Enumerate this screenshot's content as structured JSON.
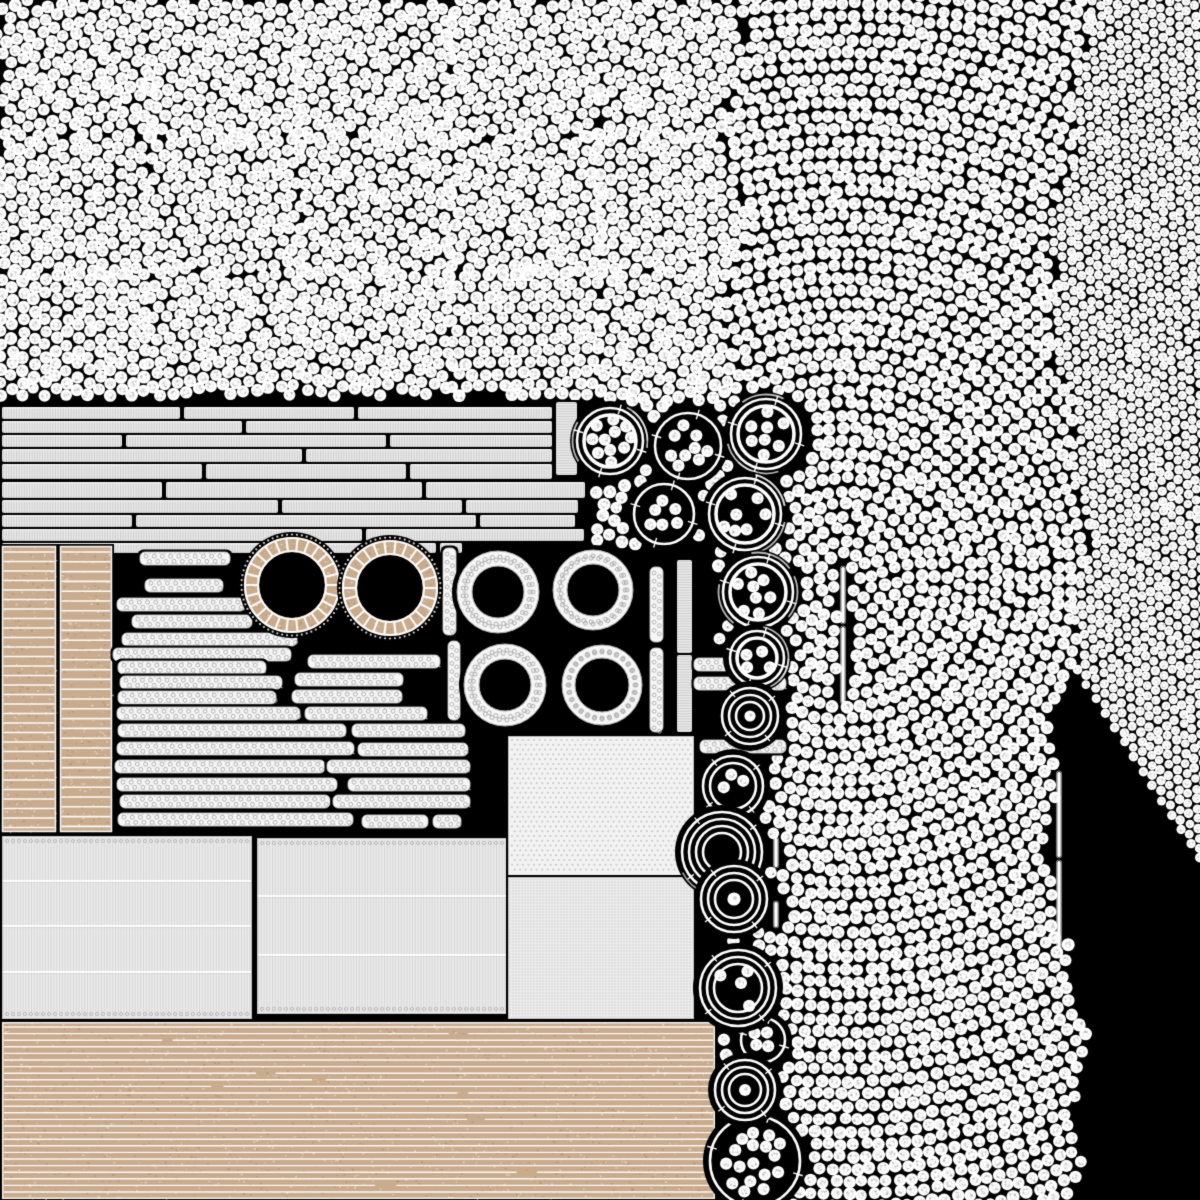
{
  "scene": {
    "width": 1200,
    "height": 1200,
    "background": "#000000",
    "seed": 11
  },
  "palette": {
    "dot": "#ffffff",
    "dot_speckle": "rgba(150,150,150,0.45)",
    "dot_ring": "rgba(170,170,170,0.35)",
    "plank": "#e9e9e9",
    "strip": "#f6f6f6",
    "sheet": "#ebebeb",
    "square": "#f3f3f3",
    "tan": "#c9ab8e",
    "tan_dark": "rgba(150,110,70,0.35)",
    "tan_light": "rgba(255,246,230,0.5)",
    "white": "#ffffff",
    "gray_line": "#b5b5b5"
  },
  "dot_field": {
    "center": [
      845,
      580
    ],
    "spacing": 12.7,
    "dot_radius": 6.2,
    "fine_spacing": 9.9,
    "fine_dot_radius": 4.6,
    "fine_boundary_x": 1068,
    "fine_angle_deg": -33,
    "linear_max_y": 404,
    "linear_max_x": 735,
    "linear_cell": [
      150,
      136
    ],
    "max_radius": 1080,
    "exclusion_rects": [
      [
        0,
        396,
        592,
        152
      ],
      [
        0,
        545,
        716,
        655
      ]
    ]
  },
  "sticks": [
    [
      843,
      567,
      3.5,
      56
    ],
    [
      843,
      627,
      3.5,
      76
    ],
    [
      1059,
      772,
      3.5,
      85
    ],
    [
      1059,
      861,
      3.5,
      87
    ],
    [
      776,
      838,
      3.5,
      29
    ],
    [
      776,
      902,
      3.5,
      25
    ]
  ],
  "planks": {
    "rows": [
      {
        "y": 407,
        "h": 12,
        "segs": [
          [
            2,
            178
          ],
          [
            184,
            170
          ],
          [
            358,
            194
          ]
        ]
      },
      {
        "y": 421,
        "h": 12,
        "segs": [
          [
            2,
            240
          ],
          [
            246,
            306
          ]
        ]
      },
      {
        "y": 435,
        "h": 12,
        "segs": [
          [
            2,
            120
          ],
          [
            126,
            260
          ],
          [
            390,
            162
          ]
        ]
      },
      {
        "y": 449,
        "h": 13,
        "segs": [
          [
            2,
            300
          ],
          [
            306,
            246
          ]
        ]
      },
      {
        "y": 464,
        "h": 15,
        "segs": [
          [
            2,
            200
          ],
          [
            206,
            200
          ],
          [
            410,
            142
          ]
        ]
      },
      {
        "y": 482,
        "h": 16,
        "segs": [
          [
            2,
            160
          ],
          [
            166,
            256
          ],
          [
            426,
            159
          ]
        ]
      },
      {
        "y": 500,
        "h": 13,
        "segs": [
          [
            2,
            276
          ],
          [
            282,
            180
          ],
          [
            466,
            112
          ]
        ]
      },
      {
        "y": 515,
        "h": 12,
        "segs": [
          [
            2,
            130
          ],
          [
            136,
            340
          ],
          [
            480,
            95
          ]
        ]
      },
      {
        "y": 529,
        "h": 12,
        "segs": [
          [
            2,
            360
          ],
          [
            366,
            218
          ]
        ]
      },
      {
        "y": 543,
        "h": 10,
        "segs": [
          [
            2,
            434
          ],
          [
            440,
            22
          ]
        ]
      }
    ]
  },
  "vplanks": [
    [
      556,
      402,
      21,
      73
    ],
    [
      677,
      560,
      15,
      93
    ],
    [
      677,
      655,
      15,
      77
    ]
  ],
  "strips": {
    "height": 13,
    "items": [
      [
        140,
        552,
        90
      ],
      [
        145,
        579,
        78
      ],
      [
        117,
        598,
        128
      ],
      [
        132,
        615,
        120
      ],
      [
        122,
        633,
        175
      ],
      [
        113,
        648,
        178
      ],
      [
        118,
        661,
        148
      ],
      [
        120,
        676,
        162
      ],
      [
        118,
        691,
        158
      ],
      [
        117,
        707,
        183
      ],
      [
        118,
        724,
        228
      ],
      [
        117,
        742,
        237
      ],
      [
        115,
        760,
        210
      ],
      [
        117,
        778,
        220
      ],
      [
        120,
        795,
        210
      ],
      [
        118,
        813,
        235
      ],
      [
        308,
        655,
        132
      ],
      [
        295,
        673,
        108
      ],
      [
        292,
        690,
        110
      ],
      [
        305,
        707,
        122
      ],
      [
        352,
        724,
        113
      ],
      [
        358,
        743,
        110
      ],
      [
        327,
        760,
        143
      ],
      [
        348,
        778,
        122
      ],
      [
        333,
        795,
        137
      ],
      [
        362,
        815,
        66
      ],
      [
        433,
        815,
        28
      ],
      [
        694,
        658,
        92
      ],
      [
        694,
        677,
        92
      ],
      [
        700,
        740,
        86
      ]
    ]
  },
  "vstrips": [
    [
      443,
      548,
      13,
      87
    ],
    [
      448,
      641,
      12,
      79
    ],
    [
      650,
      567,
      13,
      75
    ],
    [
      650,
      648,
      13,
      84
    ]
  ],
  "tan_rings": [
    {
      "cx": 292,
      "cy": 585,
      "ro": 48,
      "ri": 33,
      "spokes": 26
    },
    {
      "cx": 390,
      "cy": 588,
      "ro": 48,
      "ri": 33,
      "spokes": 26
    }
  ],
  "dotted_rings": [
    {
      "cx": 498,
      "cy": 592,
      "ro": 41,
      "ri": 26
    },
    {
      "cx": 593,
      "cy": 590,
      "ro": 40,
      "ri": 26
    },
    {
      "cx": 505,
      "cy": 685,
      "ro": 41,
      "ri": 26
    },
    {
      "cx": 602,
      "cy": 685,
      "ro": 40,
      "ri": 27
    }
  ],
  "bundles": [
    {
      "cx": 610,
      "cy": 441,
      "r": 33,
      "ring": "double",
      "dots": 11
    },
    {
      "cx": 688,
      "cy": 446,
      "r": 33,
      "ring": "single",
      "dots": 12
    },
    {
      "cx": 766,
      "cy": 434,
      "r": 35,
      "ring": "double",
      "dots": 8
    },
    {
      "cx": 664,
      "cy": 514,
      "r": 30,
      "ring": "single",
      "dots": 9
    },
    {
      "cx": 745,
      "cy": 514,
      "r": 36,
      "ring": "double",
      "dots": 7
    },
    {
      "cx": 758,
      "cy": 592,
      "r": 35,
      "ring": "double",
      "dots": 8
    },
    {
      "cx": 757,
      "cy": 658,
      "r": 27,
      "ring": "double",
      "dots": 4
    },
    {
      "cx": 763,
      "cy": 1040,
      "r": 22,
      "ring": "single",
      "dots": 4
    },
    {
      "cx": 755,
      "cy": 1161,
      "r": 45,
      "ring": "single",
      "dots": 17
    }
  ],
  "coils": [
    {
      "cx": 750,
      "cy": 716,
      "r": 28,
      "rings": 3,
      "center": "dot",
      "dots": 0
    },
    {
      "cx": 733,
      "cy": 786,
      "r": 30,
      "rings": 2,
      "center": "none",
      "dots": 3
    },
    {
      "cx": 722,
      "cy": 852,
      "r": 40,
      "rings": 4,
      "center": "hole",
      "dots": 0
    },
    {
      "cx": 734,
      "cy": 899,
      "r": 33,
      "rings": 3,
      "center": "dot",
      "dots": 0
    },
    {
      "cx": 738,
      "cy": 988,
      "r": 38,
      "rings": 3,
      "center": "none",
      "dots": 4
    },
    {
      "cx": 745,
      "cy": 1090,
      "r": 30,
      "rings": 3,
      "center": "dot",
      "dots": 0
    }
  ],
  "sheets": [
    {
      "x": 2,
      "y": 836,
      "w": 250,
      "h": 183,
      "seams": [
        45,
        90,
        136
      ]
    },
    {
      "x": 257,
      "y": 838,
      "w": 253,
      "h": 176,
      "seams": [
        58,
        117
      ]
    }
  ],
  "squares": [
    {
      "x": 508,
      "y": 736,
      "w": 186,
      "h": 140,
      "texture": "dots"
    },
    {
      "x": 508,
      "y": 877,
      "w": 186,
      "h": 142,
      "texture": "grid"
    }
  ],
  "tan_columns": [
    {
      "x": 2,
      "y": 546,
      "w": 54,
      "h": 286,
      "pitch": 9.5
    },
    {
      "x": 60,
      "y": 546,
      "w": 52,
      "h": 286,
      "pitch": 9.8
    }
  ],
  "tan_board": {
    "x": 2,
    "y": 1022,
    "w": 713,
    "h": 177,
    "pitch": 6.6
  }
}
